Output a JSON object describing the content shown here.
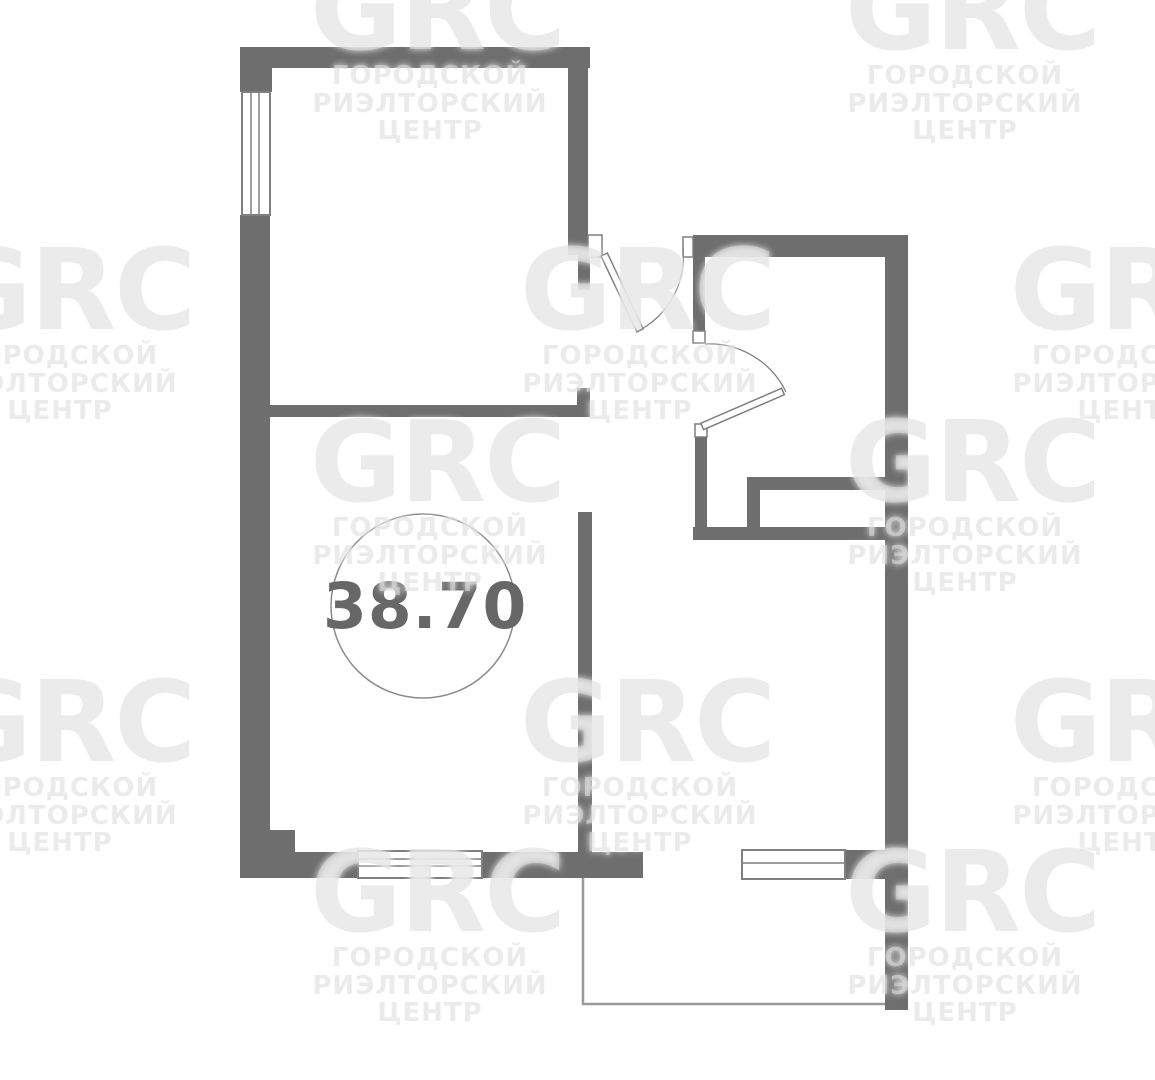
{
  "floorplan": {
    "area_value": "38.70",
    "colors": {
      "wall": "#6e6e6e",
      "window_frame": "#7f7f7f",
      "door_line": "#7f7f7f",
      "balcony_line": "#9a9a9a",
      "area_circle_stroke": "#8a8a8a",
      "area_text": "#676767",
      "watermark_text": "#e9e9e9",
      "background": "#ffffff"
    }
  },
  "watermark": {
    "logo": "GRC",
    "line1": "ГОРОДСКОЙ",
    "line2": "РИЭЛТОРСКИЙ",
    "line3": "ЦЕНТР"
  }
}
